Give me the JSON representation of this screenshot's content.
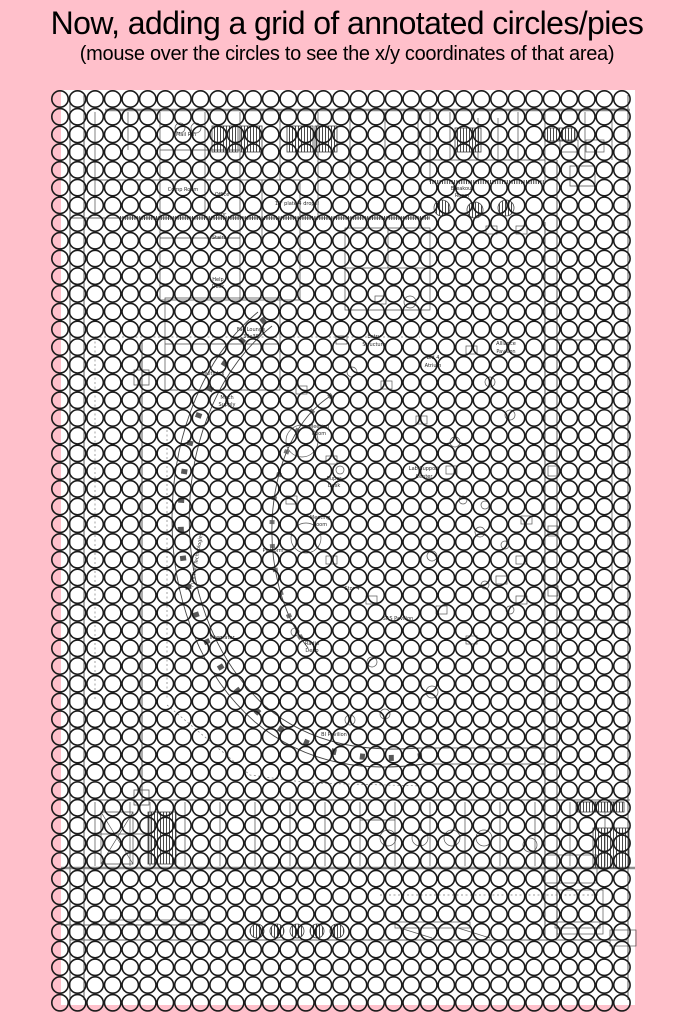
{
  "header": {
    "title": "Now, adding a grid of annotated circles/pies",
    "subtitle": "(mouse over the circles to see the x/y coordinates of that area)"
  },
  "colors": {
    "background": "#ffc0cb",
    "canvas": "#ffffff",
    "circle_stroke": "#1b1b1b",
    "plan_line": "#4f4f4f"
  },
  "canvas": {
    "x": 61,
    "y": 90,
    "width": 574,
    "height": 915,
    "fill": "#ffffff"
  },
  "grid": {
    "columns": 33,
    "rows": 52,
    "origin_x": 60,
    "origin_y": 99,
    "spacing_x": 17.56,
    "spacing_y": 17.72,
    "radius": 8.2,
    "stroke": "#1b1b1b",
    "stroke_width": 1.6
  },
  "plan": {
    "labels": [
      {
        "text": "Mail Rm",
        "x": 186,
        "y": 136
      },
      {
        "text": "Comp Room",
        "x": 183,
        "y": 191
      },
      {
        "text": "Office",
        "x": 222,
        "y": 196
      },
      {
        "text": "Stor",
        "x": 221,
        "y": 216
      },
      {
        "text": "Stairs",
        "x": 219,
        "y": 239
      },
      {
        "text": "18' plate 4 drops!",
        "x": 297,
        "y": 205
      },
      {
        "text": "Breakout",
        "x": 462,
        "y": 190
      },
      {
        "text": "Room",
        "x": 462,
        "y": 197
      },
      {
        "text": "Help",
        "x": 218,
        "y": 281
      },
      {
        "text": "Desk",
        "x": 218,
        "y": 288
      },
      {
        "text": "Fac Lounge",
        "x": 251,
        "y": 331
      },
      {
        "text": "30x30",
        "x": 251,
        "y": 338
      },
      {
        "text": "Multiplex",
        "x": 213,
        "y": 375
      },
      {
        "text": "Mech",
        "x": 227,
        "y": 399
      },
      {
        "text": "Supply",
        "x": 227,
        "y": 406
      },
      {
        "text": "Entry",
        "x": 374,
        "y": 338
      },
      {
        "text": "Structure",
        "x": 374,
        "y": 346
      },
      {
        "text": "Bld 4",
        "x": 433,
        "y": 359
      },
      {
        "text": "Atrium",
        "x": 433,
        "y": 367
      },
      {
        "text": "Meeting",
        "x": 319,
        "y": 428
      },
      {
        "text": "Room",
        "x": 319,
        "y": 435
      },
      {
        "text": "Super",
        "x": 334,
        "y": 480
      },
      {
        "text": "Desk",
        "x": 334,
        "y": 487
      },
      {
        "text": "Alliance",
        "x": 506,
        "y": 345
      },
      {
        "text": "Pavilion",
        "x": 506,
        "y": 353
      },
      {
        "text": "Lab Support",
        "x": 424,
        "y": 470
      },
      {
        "text": "Center",
        "x": 424,
        "y": 478
      },
      {
        "text": "Meeting",
        "x": 320,
        "y": 519
      },
      {
        "text": "Room",
        "x": 320,
        "y": 526
      },
      {
        "text": "Platform",
        "x": 273,
        "y": 552
      },
      {
        "text": "Stor 4",
        "x": 352,
        "y": 590
      },
      {
        "text": "Radio",
        "x": 312,
        "y": 645
      },
      {
        "text": "Depo",
        "x": 312,
        "y": 652
      },
      {
        "text": "SAS Pavilion",
        "x": 398,
        "y": 620
      },
      {
        "text": "Integrator",
        "x": 222,
        "y": 639
      },
      {
        "text": "BI Pavilion",
        "x": 334,
        "y": 736
      },
      {
        "text": "Function Technologies",
        "x": 198,
        "y": 560,
        "rotate": -80
      }
    ]
  }
}
